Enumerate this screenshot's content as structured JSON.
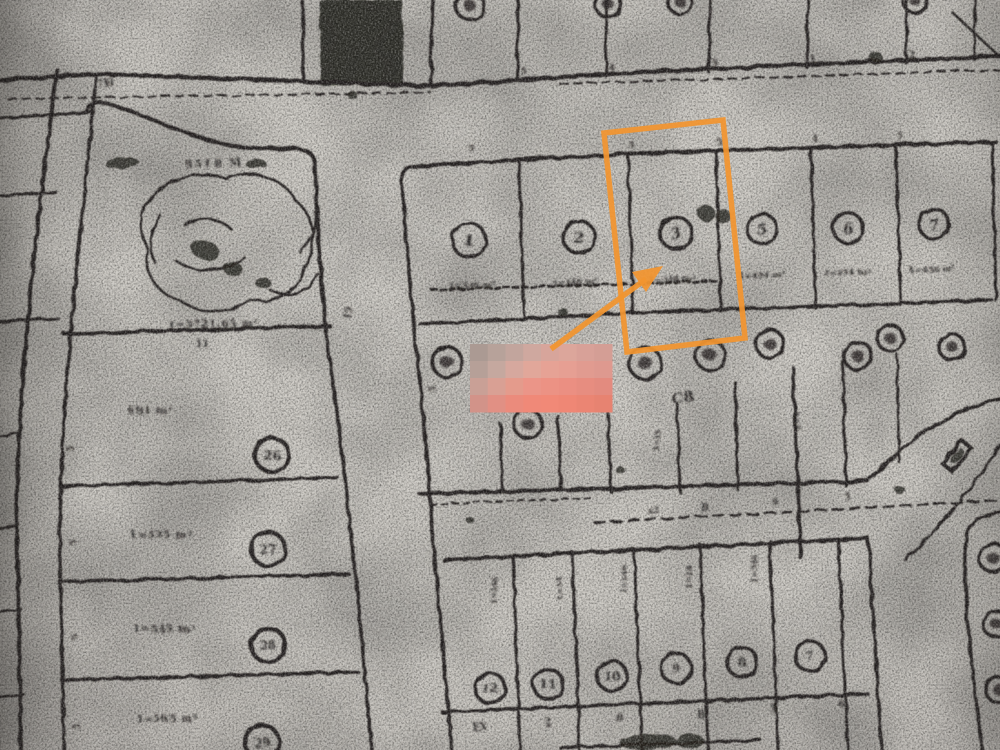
{
  "scan": {
    "paper_color": "#cdcac4",
    "paper_edge_color": "#b2aea9",
    "ink_color": "#262320",
    "orange_accent": "#f2952f",
    "legibility_note": "photocopy scan, most small labels blurred"
  },
  "annotations": {
    "highlight_box": {
      "color": "#f2952f",
      "points": "604,133 723,120 745,338 627,352",
      "stroke_width": 5.5
    },
    "arrow": {
      "color": "#f2952f",
      "x1": 551,
      "y1": 349,
      "x2": 646,
      "y2": 279,
      "head_points": "663,266 646,292 632,272"
    },
    "redaction_mosaic": {
      "x": 470,
      "y": 344,
      "w": 142,
      "h": 68,
      "cols": 8,
      "rows": 4,
      "palette": [
        "#ab9a93",
        "#b7a29a",
        "#c2a59d",
        "#cfa89f",
        "#d7a59b",
        "#dca69b",
        "#d8a198",
        "#d49e95",
        "#b6a098",
        "#c5a89f",
        "#d6a89e",
        "#e1a79a",
        "#e6a295",
        "#e69f93",
        "#e19b90",
        "#de998f",
        "#c9a096",
        "#d9a094",
        "#e49b8c",
        "#eb9588",
        "#ec9284",
        "#eb8f82",
        "#e78d80",
        "#e38b7f",
        "#d29389",
        "#e19084",
        "#eb8b7c",
        "#f08978",
        "#f18977",
        "#ef8775",
        "#eb8573",
        "#e78371"
      ]
    }
  },
  "parcels": {
    "top_row_numbers": [
      {
        "label": "1",
        "x": 469,
        "y": 240,
        "r": 17
      },
      {
        "label": "2",
        "x": 579,
        "y": 237,
        "r": 16
      },
      {
        "label": "3",
        "x": 676,
        "y": 233,
        "r": 16
      },
      {
        "label": "5",
        "x": 762,
        "y": 229,
        "r": 15
      },
      {
        "label": "6",
        "x": 848,
        "y": 228,
        "r": 15
      },
      {
        "label": "7",
        "x": 934,
        "y": 224,
        "r": 15
      }
    ],
    "top_row_areas": [
      {
        "s": "1=346 m²",
        "x": 472,
        "y": 288
      },
      {
        "s": "1=346 m²",
        "x": 575,
        "y": 285
      },
      {
        "s": "1=348 m²",
        "x": 672,
        "y": 282
      },
      {
        "s": "1=454 m²",
        "x": 762,
        "y": 278
      },
      {
        "s": "1=454 m²",
        "x": 847,
        "y": 275
      },
      {
        "s": "1=456 m²",
        "x": 932,
        "y": 272
      }
    ],
    "left_column": [
      {
        "area": "691 m²",
        "ax": 128,
        "ay": 414,
        "label": "26",
        "x": 272,
        "y": 455
      },
      {
        "area": "1=535 m²",
        "ax": 130,
        "ay": 538,
        "label": "27",
        "x": 268,
        "y": 549
      },
      {
        "area": "1=545 m²",
        "ax": 133,
        "ay": 632,
        "label": "28",
        "x": 268,
        "y": 645
      },
      {
        "area": "1=565 m²",
        "ax": 136,
        "ay": 722,
        "label": "29",
        "x": 262,
        "y": 742
      }
    ],
    "bottom_row_numbers": [
      {
        "label": "12",
        "x": 490,
        "y": 688,
        "r": 15
      },
      {
        "label": "11",
        "x": 548,
        "y": 684,
        "r": 15
      },
      {
        "label": "10",
        "x": 612,
        "y": 676,
        "r": 15
      },
      {
        "label": "9",
        "x": 676,
        "y": 668,
        "r": 15
      },
      {
        "label": "8",
        "x": 742,
        "y": 662,
        "r": 15
      },
      {
        "label": "7",
        "x": 810,
        "y": 656,
        "r": 15
      }
    ],
    "middle_row_circles_illegible": [
      {
        "x": 447,
        "y": 362,
        "r": 15
      },
      {
        "x": 528,
        "y": 424,
        "r": 14
      },
      {
        "x": 645,
        "y": 363,
        "r": 16
      },
      {
        "x": 710,
        "y": 355,
        "r": 15
      },
      {
        "x": 770,
        "y": 344,
        "r": 14
      },
      {
        "x": 858,
        "y": 356,
        "r": 14
      },
      {
        "x": 890,
        "y": 338,
        "r": 13
      },
      {
        "x": 952,
        "y": 347,
        "r": 13
      }
    ],
    "top_edge_partial_circles": [
      {
        "x": 470,
        "y": 6,
        "r": 14
      },
      {
        "x": 608,
        "y": 4,
        "r": 13
      },
      {
        "x": 680,
        "y": 2,
        "r": 12
      },
      {
        "x": 915,
        "y": 1,
        "r": 12
      }
    ],
    "right_edge_partial_circles": [
      {
        "x": 993,
        "y": 558,
        "r": 14
      },
      {
        "x": 996,
        "y": 624,
        "r": 13
      },
      {
        "x": 999,
        "y": 690,
        "r": 13
      }
    ],
    "large_parcel": {
      "top_label": "9518 M",
      "bottom_label": "1=5721,65 m²"
    },
    "block_label": "C8"
  },
  "vertical_texts": [
    {
      "s": "1=346",
      "x": 497,
      "y": 605
    },
    {
      "s": "1=34",
      "x": 562,
      "y": 600
    },
    {
      "s": "1=346",
      "x": 627,
      "y": 594
    },
    {
      "s": "1=34",
      "x": 692,
      "y": 589
    },
    {
      "s": "1=346",
      "x": 757,
      "y": 583
    },
    {
      "s": "1=35",
      "x": 660,
      "y": 452
    },
    {
      "s": "1=4",
      "x": 800,
      "y": 430
    }
  ],
  "tick_marks": [
    {
      "s": "7H",
      "x": 98,
      "y": 88,
      "rot": -10,
      "size": 10
    },
    {
      "s": "5",
      "x": 520,
      "y": 74,
      "rot": 0,
      "size": 9
    },
    {
      "s": "4",
      "x": 608,
      "y": 70,
      "rot": 0,
      "size": 9
    },
    {
      "s": "5",
      "x": 712,
      "y": 66,
      "rot": 0,
      "size": 9
    },
    {
      "s": "1",
      "x": 810,
      "y": 62,
      "rot": 0,
      "size": 9
    },
    {
      "s": "2",
      "x": 908,
      "y": 58,
      "rot": 0,
      "size": 10
    },
    {
      "s": "5",
      "x": 468,
      "y": 151,
      "rot": 0,
      "size": 9
    },
    {
      "s": "5",
      "x": 628,
      "y": 148,
      "rot": 0,
      "size": 9
    },
    {
      "s": "5",
      "x": 716,
      "y": 145,
      "rot": 0,
      "size": 9
    },
    {
      "s": "4",
      "x": 812,
      "y": 142,
      "rot": 0,
      "size": 9
    },
    {
      "s": "5",
      "x": 897,
      "y": 139,
      "rot": 0,
      "size": 9
    },
    {
      "s": "15",
      "x": 350,
      "y": 320,
      "rot": -80,
      "size": 9
    },
    {
      "s": "11",
      "x": 195,
      "y": 347,
      "rot": 0,
      "size": 10
    },
    {
      "s": "5",
      "x": 74,
      "y": 452,
      "rot": -90,
      "size": 9
    },
    {
      "s": "5",
      "x": 76,
      "y": 545,
      "rot": -90,
      "size": 9
    },
    {
      "s": "5",
      "x": 78,
      "y": 640,
      "rot": -90,
      "size": 9
    },
    {
      "s": "5",
      "x": 80,
      "y": 730,
      "rot": -90,
      "size": 9
    },
    {
      "s": "5",
      "x": 436,
      "y": 392,
      "rot": -90,
      "size": 9
    },
    {
      "s": "x2",
      "x": 648,
      "y": 514,
      "rot": -5,
      "size": 9
    },
    {
      "s": "B",
      "x": 700,
      "y": 510,
      "rot": 0,
      "size": 10
    },
    {
      "s": "9",
      "x": 772,
      "y": 505,
      "rot": 0,
      "size": 9
    },
    {
      "s": "5",
      "x": 845,
      "y": 500,
      "rot": 0,
      "size": 9
    },
    {
      "s": "EX",
      "x": 472,
      "y": 730,
      "rot": 0,
      "size": 10
    },
    {
      "s": "2",
      "x": 545,
      "y": 726,
      "rot": 0,
      "size": 10
    },
    {
      "s": "B",
      "x": 615,
      "y": 721,
      "rot": 0,
      "size": 10
    },
    {
      "s": "B",
      "x": 697,
      "y": 718,
      "rot": 0,
      "size": 10
    },
    {
      "s": "5",
      "x": 770,
      "y": 712,
      "rot": 0,
      "size": 10
    },
    {
      "s": "6",
      "x": 838,
      "y": 707,
      "rot": 0,
      "size": 10
    }
  ],
  "map_geometry": {
    "lines": [
      {
        "d": "M0,80 L95,74 L430,86 L640,72 L1000,56",
        "w": 4.5
      },
      {
        "d": "M8,99 L430,92",
        "w": 2,
        "dash": "8 6"
      },
      {
        "d": "M560,84 L1000,70",
        "w": 2,
        "dash": "8 6"
      },
      {
        "d": "M303,0 L303,78",
        "w": 3.5
      },
      {
        "d": "M432,0 L431,84",
        "w": 3.5
      },
      {
        "d": "M518,0 L517,80",
        "w": 3
      },
      {
        "d": "M607,0 L606,76",
        "w": 3
      },
      {
        "d": "M710,0 L709,72",
        "w": 3
      },
      {
        "d": "M808,0 L807,68",
        "w": 3
      },
      {
        "d": "M907,0 L906,63",
        "w": 3
      },
      {
        "d": "M975,0 L974,60",
        "w": 2.5
      },
      {
        "d": "M953,13 L1000,57",
        "w": 2.5
      },
      {
        "d": "M57,70 C38,220 16,380 17,540 L21,750",
        "w": 4
      },
      {
        "d": "M96,78 C80,240 58,420 60,560 L64,750",
        "w": 3.5
      },
      {
        "d": "M0,118 L92,112",
        "w": 3
      },
      {
        "d": "M0,196 L56,192",
        "w": 3
      },
      {
        "d": "M0,322 L58,318",
        "w": 3
      },
      {
        "d": "M0,436 L18,433",
        "w": 2.5
      },
      {
        "d": "M0,528 L19,525",
        "w": 2.5
      },
      {
        "d": "M0,612 L21,609",
        "w": 2.5
      },
      {
        "d": "M0,697 L23,694",
        "w": 2.5
      },
      {
        "d": "M86,112 Q89,102 100,102 C140,110 190,142 250,148 L298,149 Q313,150 315,163 L319,245 L326,332",
        "w": 4
      },
      {
        "d": "M64,334 L330,326",
        "w": 4
      },
      {
        "d": "M326,332 L338,420 L346,490 L358,600 L372,750",
        "w": 3.5
      },
      {
        "d": "M60,486 L338,478",
        "w": 3.5
      },
      {
        "d": "M61,582 L349,574",
        "w": 3.5
      },
      {
        "d": "M62,680 L358,672",
        "w": 3.5
      },
      {
        "d": "M402,182 C408,280 420,380 428,470 C434,560 444,660 452,750",
        "w": 3.5
      },
      {
        "d": "M402,182 Q401,167 416,166 L640,153 L996,142",
        "w": 4
      },
      {
        "d": "M420,324 L630,313 L992,300",
        "w": 3.5
      },
      {
        "d": "M992,143 L996,300",
        "w": 3
      },
      {
        "d": "M519,160 L524,318",
        "w": 3
      },
      {
        "d": "M628,156 L633,314",
        "w": 3
      },
      {
        "d": "M716,153 L721,311",
        "w": 3
      },
      {
        "d": "M811,150 L816,308",
        "w": 3
      },
      {
        "d": "M896,147 L901,305",
        "w": 3
      },
      {
        "d": "M432,290 L718,281",
        "w": 3,
        "dash": "5 4"
      },
      {
        "d": "M420,494 L868,481",
        "w": 4
      },
      {
        "d": "M868,481 Q938,410 1000,399",
        "w": 3.5
      },
      {
        "d": "M905,560 Q962,505 1000,446",
        "w": 3
      },
      {
        "d": "M430,504 L590,498",
        "w": 2,
        "dash": "6 5"
      },
      {
        "d": "M595,523 L1000,500",
        "w": 2.5,
        "dash": "10 7"
      },
      {
        "d": "M500,424 L503,492",
        "w": 3
      },
      {
        "d": "M558,416 L561,491",
        "w": 3
      },
      {
        "d": "M607,388 L611,492",
        "w": 3
      },
      {
        "d": "M677,404 L680,492",
        "w": 3
      },
      {
        "d": "M735,382 L738,490",
        "w": 3
      },
      {
        "d": "M793,368 L801,558",
        "w": 3.5
      },
      {
        "d": "M843,362 L846,486",
        "w": 3
      },
      {
        "d": "M897,354 L899,462",
        "w": 2.5
      },
      {
        "d": "M444,560 L868,538",
        "w": 4
      },
      {
        "d": "M868,538 L882,750",
        "w": 3.5
      },
      {
        "d": "M513,556 L520,750",
        "w": 3
      },
      {
        "d": "M572,552 L580,750",
        "w": 3
      },
      {
        "d": "M634,549 L642,750",
        "w": 3
      },
      {
        "d": "M700,545 L708,750",
        "w": 3
      },
      {
        "d": "M770,541 L778,750",
        "w": 3
      },
      {
        "d": "M838,540 L848,750",
        "w": 3
      },
      {
        "d": "M442,712 L868,694",
        "w": 3.5
      },
      {
        "d": "M560,748 L760,740",
        "w": 3
      },
      {
        "d": "M1000,512 Q972,516 966,535 C961,585 972,665 982,750",
        "w": 3.5
      }
    ],
    "pond": [
      "M150,200 C165,178 200,170 225,178 C250,168 285,178 295,200 C315,215 318,245 305,265 C300,290 275,305 250,300 C230,315 195,315 180,300 C158,295 142,272 148,250 C138,230 140,212 150,200 Z",
      "M185,225 C200,215 220,218 232,230",
      "M175,260 C195,275 225,272 245,258",
      "M270,290 C290,300 310,292 318,274",
      "M300,252 C312,240 318,226 315,212",
      "M160,215 C150,230 148,248 155,262"
    ],
    "hatch_polygon": "319,0 402,0 404,84 321,86",
    "building_rect": {
      "cx": 957,
      "cy": 456,
      "w": 30,
      "h": 13,
      "rot": -50
    },
    "blobs": [
      [
        122,
        163,
        17,
        6,
        -4
      ],
      [
        256,
        164,
        10,
        5,
        -4
      ],
      [
        706,
        213,
        9,
        8,
        0
      ],
      [
        723,
        216,
        8,
        7,
        0
      ],
      [
        563,
        312,
        5,
        4,
        0
      ],
      [
        205,
        250,
        15,
        10,
        20
      ],
      [
        233,
        269,
        10,
        7,
        10
      ],
      [
        263,
        283,
        8,
        5,
        0
      ],
      [
        648,
        742,
        28,
        8,
        -3
      ],
      [
        690,
        741,
        14,
        7,
        0
      ],
      [
        876,
        57,
        6,
        5,
        0
      ],
      [
        900,
        490,
        5,
        4,
        0
      ],
      [
        620,
        470,
        4,
        4,
        0
      ],
      [
        470,
        520,
        4,
        3,
        0
      ],
      [
        352,
        95,
        5,
        4,
        0
      ],
      [
        957,
        456,
        9,
        4,
        -50
      ]
    ]
  }
}
